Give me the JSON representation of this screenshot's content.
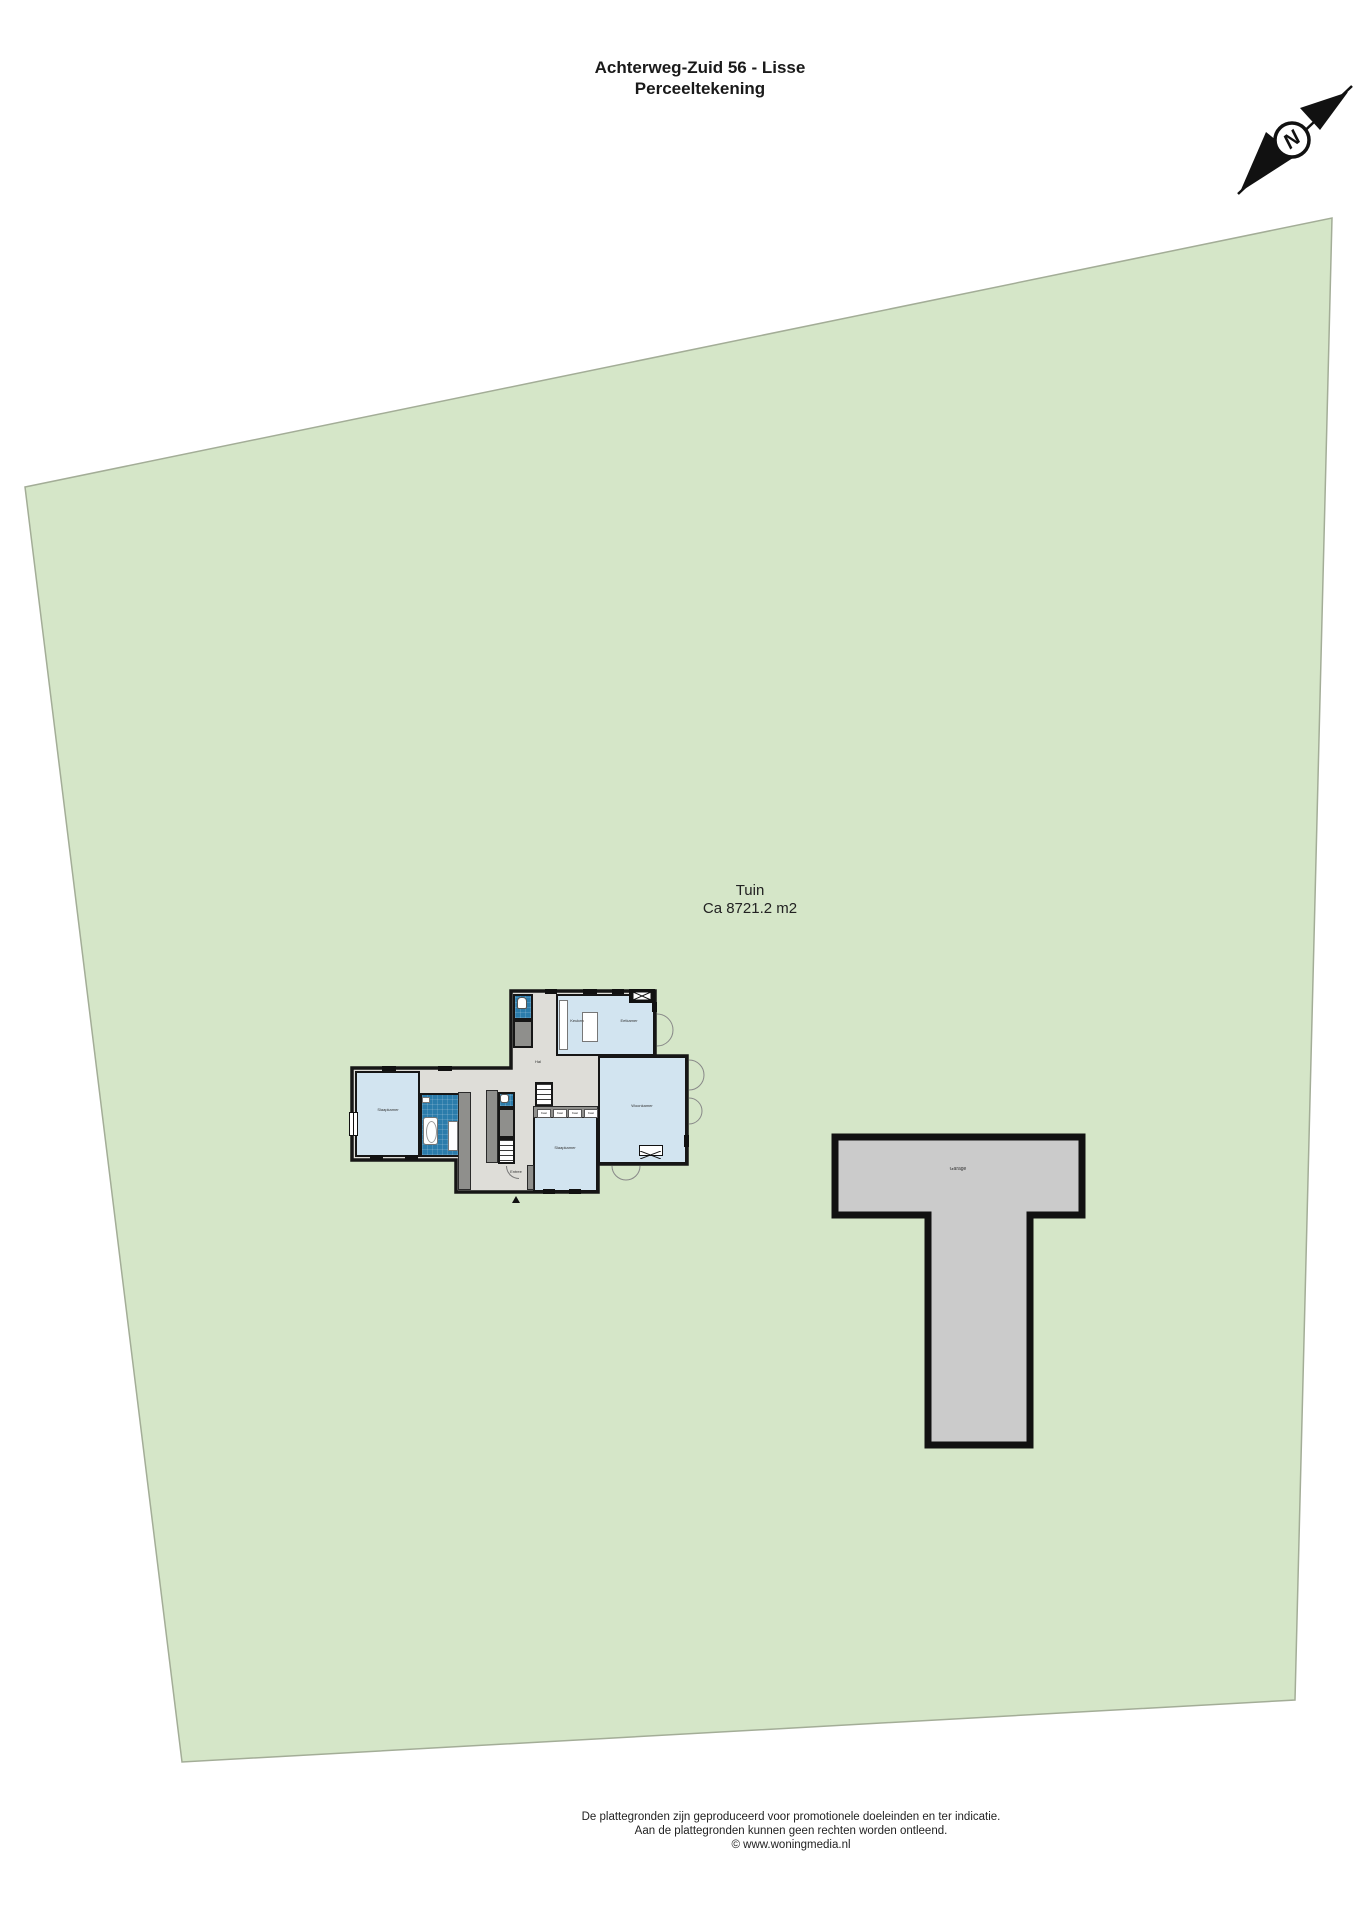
{
  "header": {
    "address": "Achterweg-Zuid 56 - Lisse",
    "subtitle": "Perceeltekening"
  },
  "plot": {
    "name": "Tuin",
    "area": "Ca 8721.2 m2"
  },
  "compass": {
    "letter": "N"
  },
  "house": {
    "rooms": {
      "bedroom_left": "Slaapkamer",
      "hall": "Hal",
      "entrance": "Entree",
      "kitchen": "Keuken",
      "dining": "Eetkamer",
      "living": "Woonkamer",
      "bedroom_bottom": "Slaapkamer",
      "closets": [
        "Kast",
        "Kast",
        "Kast",
        "Kast"
      ]
    }
  },
  "garage": {
    "label": "Garage"
  },
  "footer": {
    "line1": "De plattegronden zijn geproduceerd voor promotionele doeleinden en ter indicatie.",
    "line2": "Aan de plattegronden kunnen geen rechten worden ontleend.",
    "line3": "© www.woningmedia.nl"
  },
  "colors": {
    "plot_green": "#d5e6c8",
    "plot_border": "#a3ad97",
    "room_blue": "#d2e4f0",
    "wet_room_blue": "#2b7cab",
    "hall_gray": "#deddd8",
    "closet_gray": "#8f8f8c",
    "garage_gray": "#cbcbcb",
    "wall": "#161616"
  }
}
